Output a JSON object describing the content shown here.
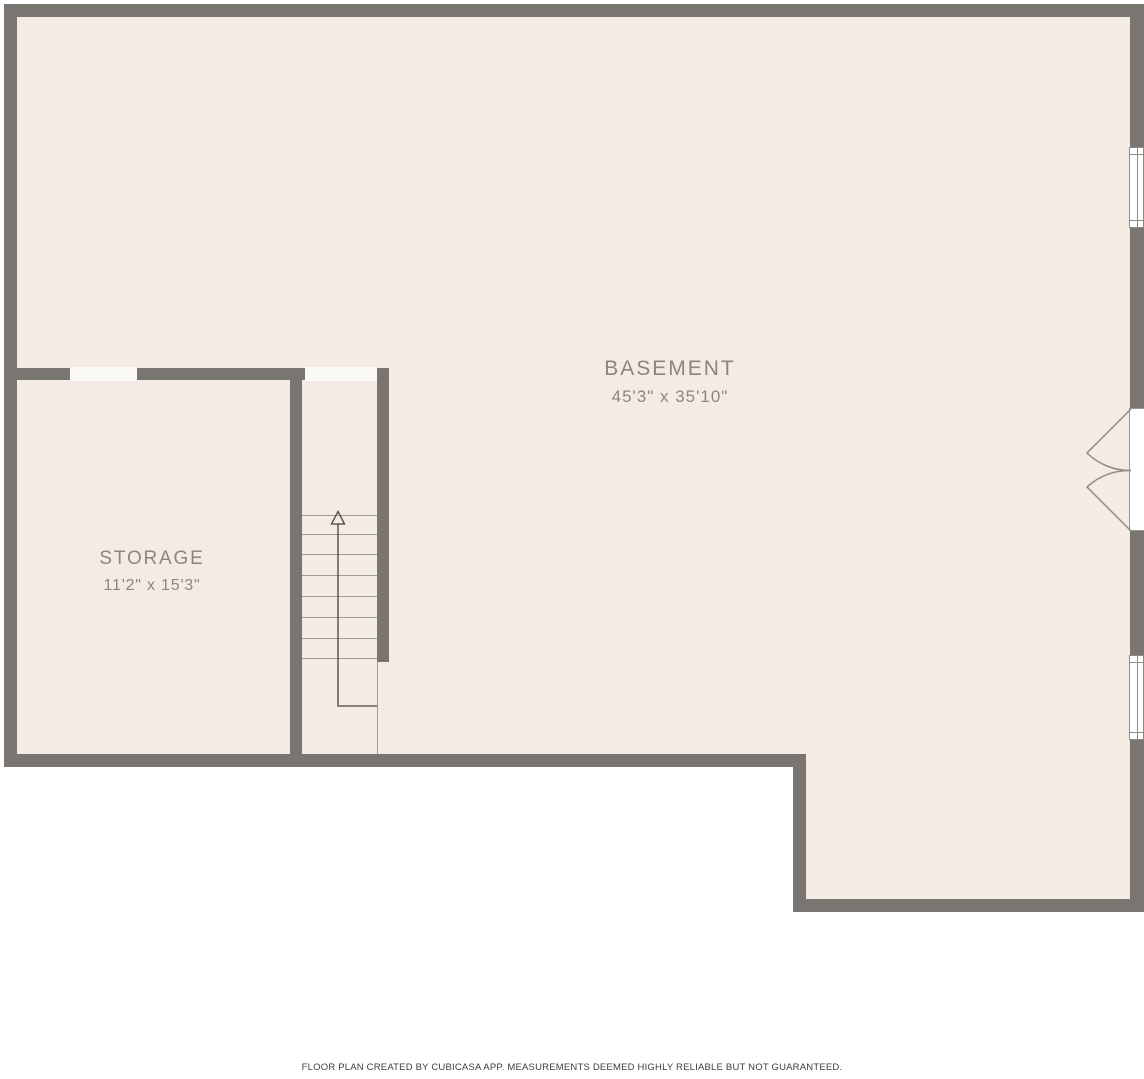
{
  "floor_plan": {
    "creator": "CubiCasa",
    "rooms": {
      "basement": {
        "name": "BASEMENT",
        "dimensions": "45'3\" x 35'10\""
      },
      "storage": {
        "name": "STORAGE",
        "dimensions": "11'2\" x 15'3\""
      }
    },
    "stairs": {
      "direction": "up",
      "step_count": 8
    },
    "features": {
      "windows": [
        "window-right-upper",
        "window-right-lower"
      ],
      "doors": [
        "storage-door-opening",
        "stair-top-opening",
        "exterior-double-door-right"
      ]
    },
    "footer": "FLOOR PLAN CREATED BY CUBICASA APP. MEASUREMENTS DEEMED HIGHLY RELIABLE BUT NOT GUARANTEED.",
    "colors": {
      "wall": "#797672",
      "floor": "#f4ebe4",
      "background": "#ffffff",
      "label_text": "#8a8680",
      "footer_text": "#3d3d3d"
    }
  }
}
